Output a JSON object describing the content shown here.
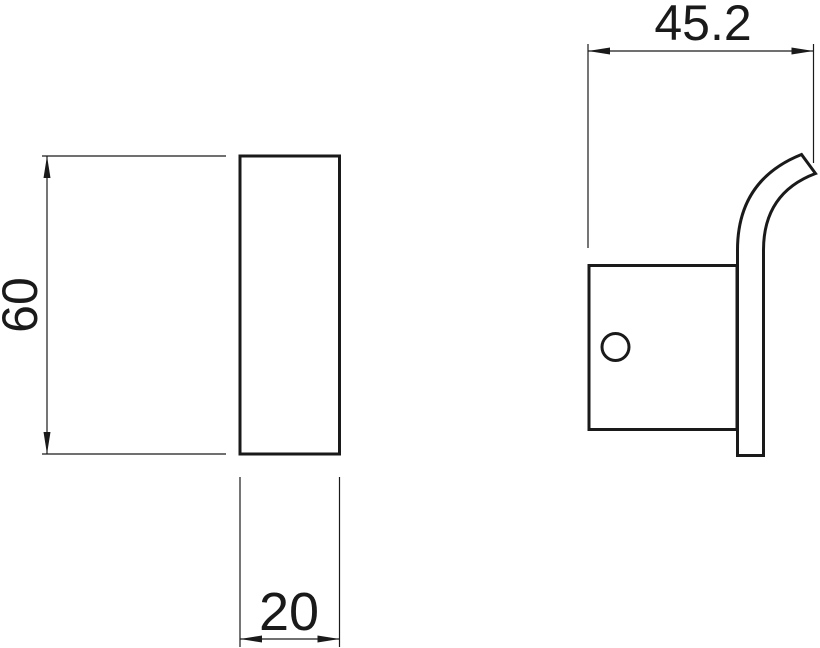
{
  "drawing": {
    "background_color": "#ffffff",
    "line_color": "#1a1a1a",
    "dimensions": {
      "front_height": "60",
      "front_width": "20",
      "side_width": "45.2"
    }
  }
}
